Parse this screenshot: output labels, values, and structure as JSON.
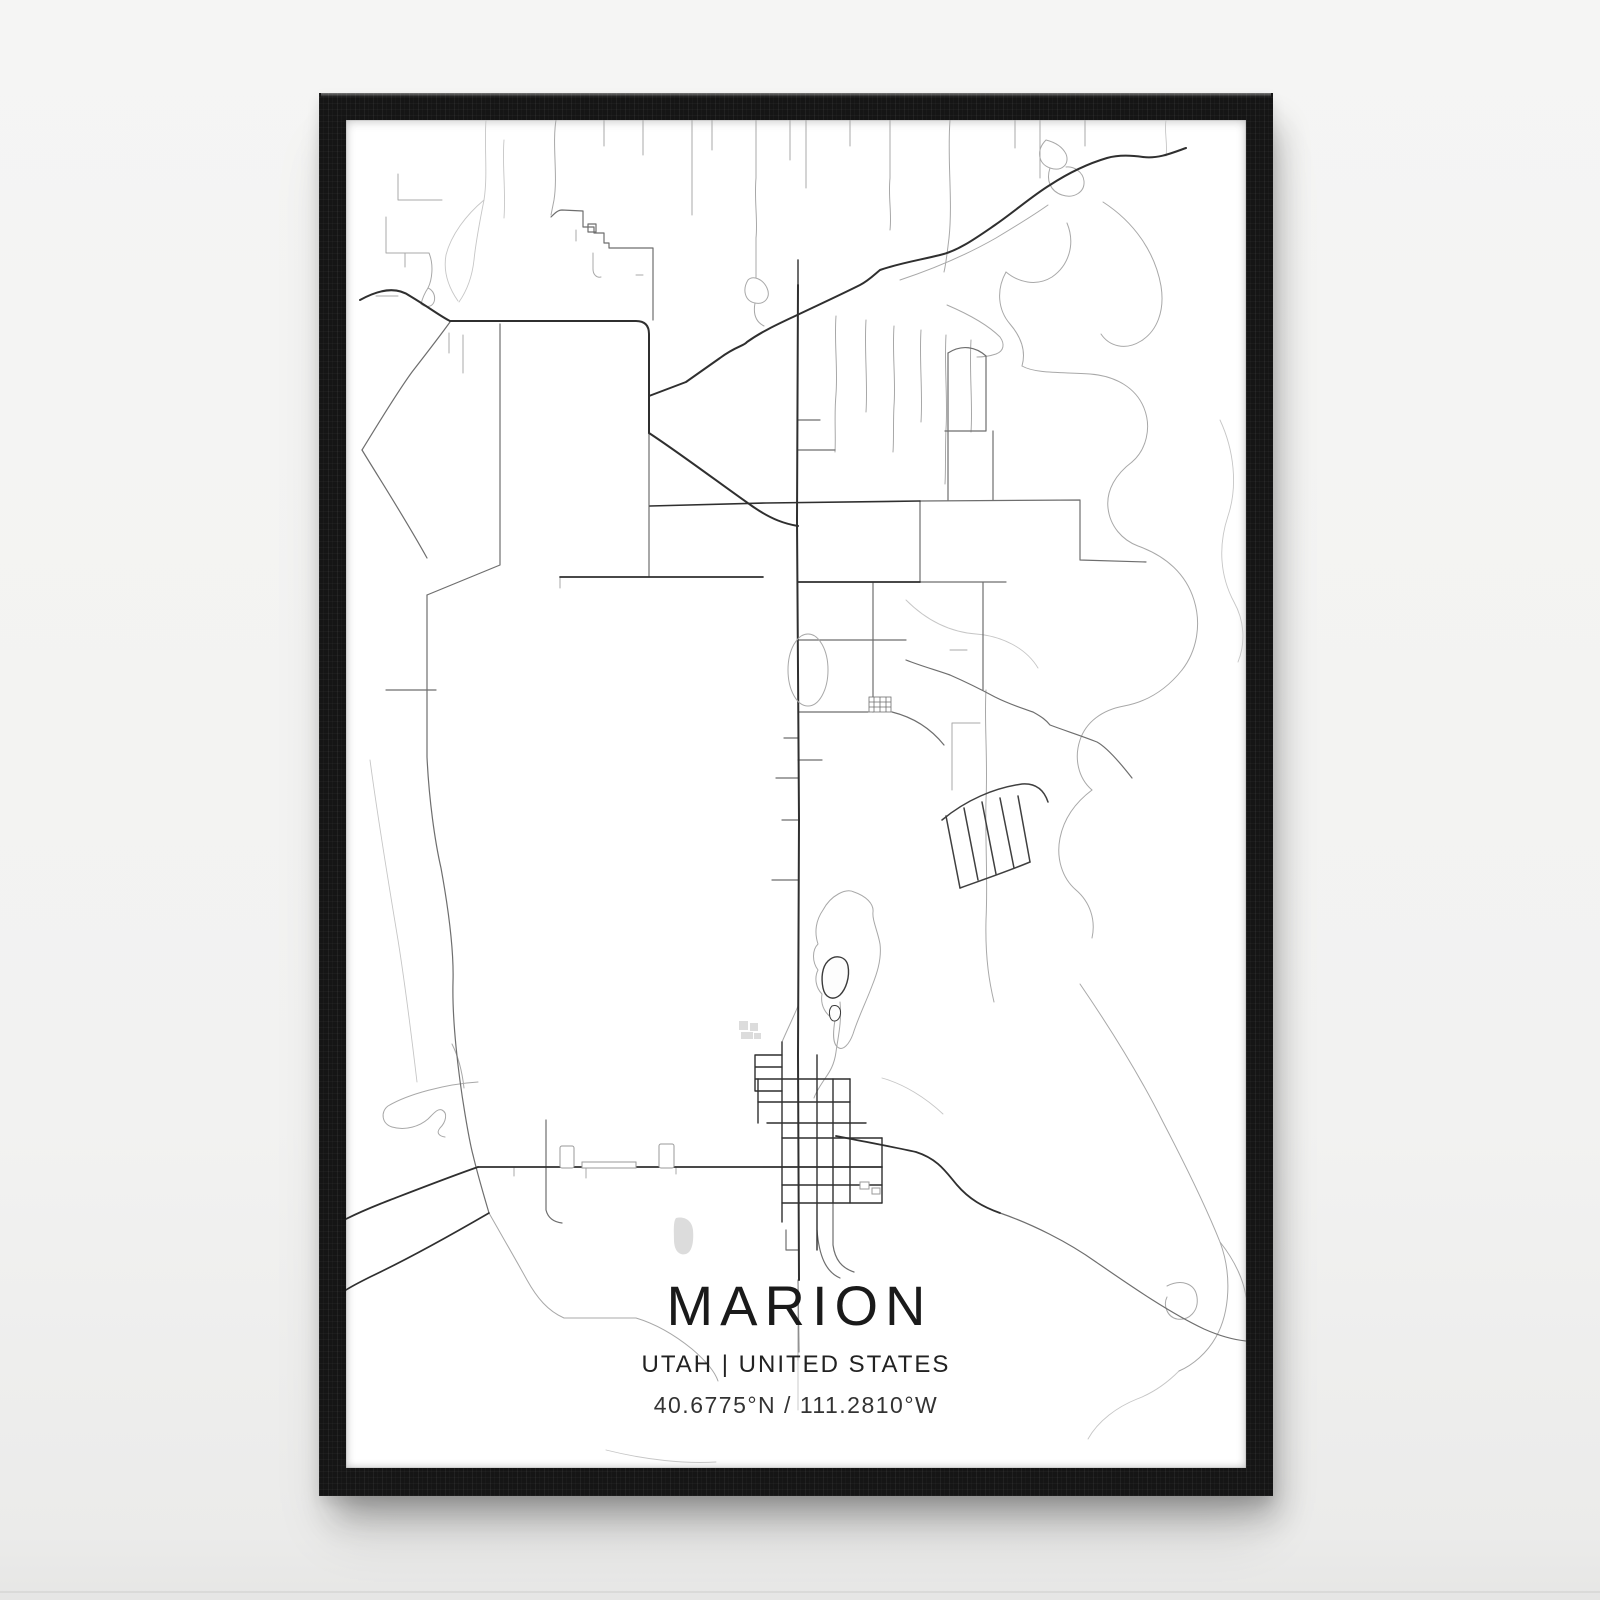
{
  "poster": {
    "title": "MARION",
    "subtitle": "UTAH | UNITED STATES",
    "coordinates": "40.6775°N / 111.2810°W"
  },
  "colors": {
    "background": "#f3f3f2",
    "frame": "#151515",
    "paper": "#ffffff",
    "road_primary": "#2f2f2f",
    "road_secondary": "#6e6e6e",
    "road_minor": "#a8a8a8",
    "road_faint": "#c6c6c6",
    "building": "#dcdcdc",
    "text": "#1a1a1a"
  }
}
